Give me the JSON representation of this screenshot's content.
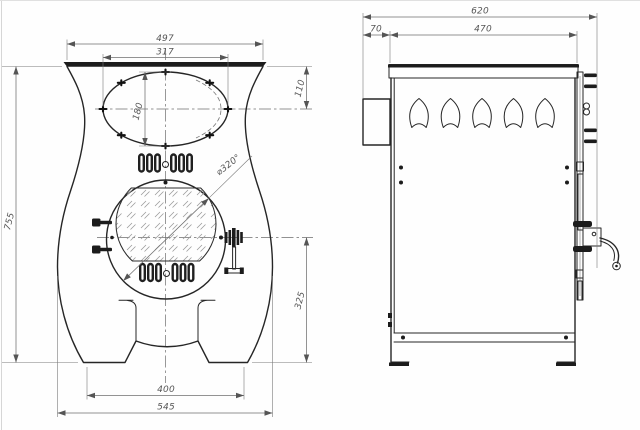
{
  "front_view": {
    "dims": {
      "overall_height": "755",
      "top_width": "497",
      "port_width": "317",
      "port_height": "180",
      "top_to_port_axis": "110",
      "door_diameter": "⌀320°",
      "door_axis_to_base": "325",
      "feet_span": "400",
      "max_width": "545"
    }
  },
  "side_view": {
    "dims": {
      "overall_depth": "620",
      "rear_ledge": "70",
      "body_depth": "470"
    }
  }
}
